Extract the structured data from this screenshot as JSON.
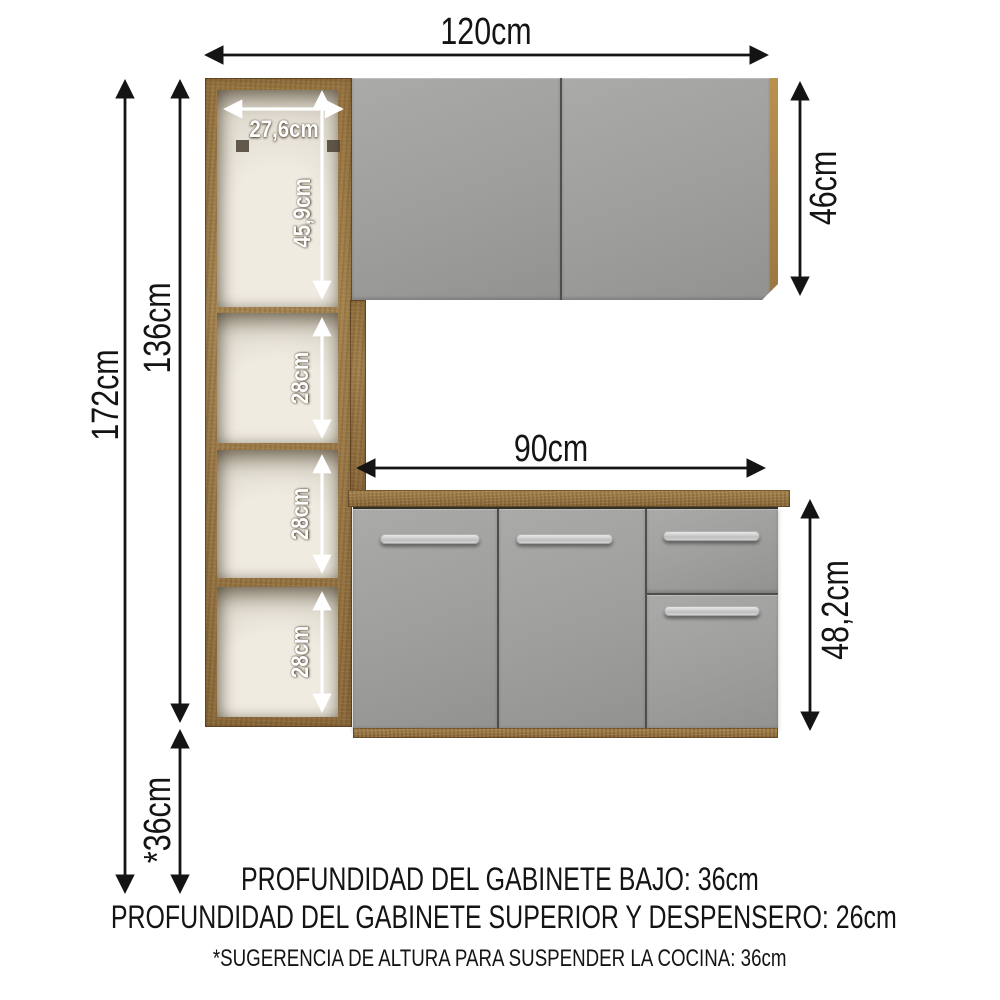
{
  "diagram": {
    "overall": {
      "width": "120cm",
      "total_height": "172cm",
      "unit_height": "136cm",
      "suspension_height": "*36cm"
    },
    "upper_cabinet": {
      "height": "46cm"
    },
    "lower_cabinet": {
      "width": "90cm",
      "height": "48,2cm"
    },
    "pantry": {
      "inner_width": "27,6cm",
      "top_opening_height": "45,9cm",
      "shelf_heights": [
        "28cm",
        "28cm",
        "28cm"
      ]
    },
    "footnotes": [
      "PROFUNDIDAD DEL GABINETE BAJO: 36cm",
      "PROFUNDIDAD DEL GABINETE SUPERIOR Y DESPENSERO: 26cm",
      "*SUGERENCIA DE ALTURA PARA SUSPENDER LA COCINA: 36cm"
    ],
    "colors": {
      "background": "#ffffff",
      "wood": "#9b7847",
      "wood_dark": "#6f522c",
      "counter_wood": "#97743f",
      "door_gray": "#9d9d9b",
      "interior_white": "#ebe6dc",
      "handle_silver": "#d8d8d8",
      "arrow_black": "#141414",
      "arrow_white": "#ffffff"
    }
  }
}
